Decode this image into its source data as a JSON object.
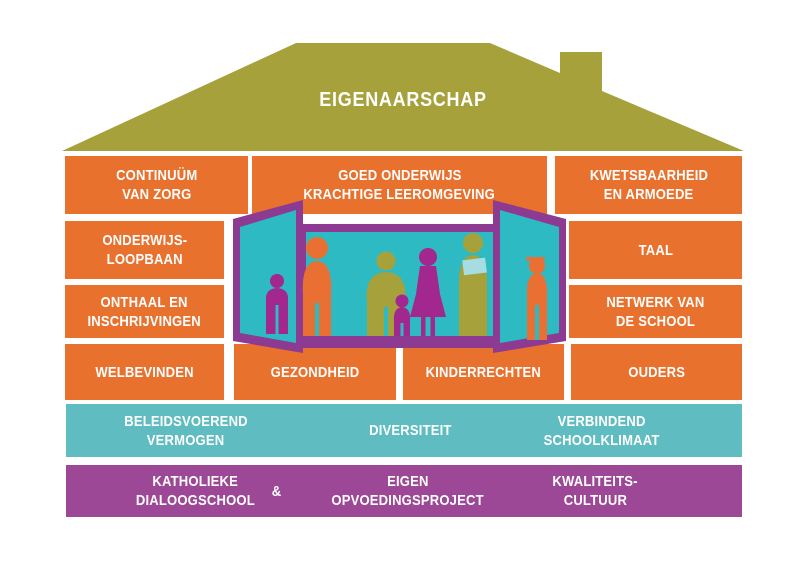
{
  "colors": {
    "roof_olive": "#A6A13B",
    "block_orange": "#E8712E",
    "bar_teal": "#5FBCC1",
    "bar_purple": "#9D4896",
    "window_frame_purple": "#8D3A92",
    "window_teal": "#2EBAC2",
    "figure_orange": "#E96F33",
    "figure_olive": "#A6A13B",
    "figure_magenta": "#A2278F",
    "tablet_light_teal": "#A5DDE3",
    "text_white": "#FFFFFF"
  },
  "roof": {
    "label": "EIGENAARSCHAP"
  },
  "rows": {
    "row1": {
      "continuum": {
        "line1": "CONTINUÜM",
        "line2": "VAN ZORG"
      },
      "goed_onderwijs": {
        "line1": "GOED ONDERWIJS",
        "line2": "KRACHTIGE LEEROMGEVING"
      },
      "kwetsbaarheid": {
        "line1": "KWETSBAARHEID",
        "line2": "EN ARMOEDE"
      }
    },
    "row2": {
      "onderwijsloopbaan": {
        "line1": "ONDERWIJS-",
        "line2": "LOOPBAAN"
      },
      "taal": {
        "line1": "TAAL"
      }
    },
    "row3": {
      "onthaal": {
        "line1": "ONTHAAL EN",
        "line2": "INSCHRIJVINGEN"
      },
      "netwerk": {
        "line1": "NETWERK VAN",
        "line2": "DE SCHOOL"
      }
    },
    "row4": {
      "welbevinden": {
        "line1": "WELBEVINDEN"
      },
      "gezondheid": {
        "line1": "GEZONDHEID"
      },
      "kinderrechten": {
        "line1": "KINDERRECHTEN"
      },
      "ouders": {
        "line1": "OUDERS"
      }
    }
  },
  "teal_bar": {
    "beleidsvoerend": {
      "line1": "BELEIDSVOEREND",
      "line2": "VERMOGEN"
    },
    "diversiteit": {
      "line1": "DIVERSITEIT"
    },
    "verbindend": {
      "line1": "VERBINDEND",
      "line2": "SCHOOLKLIMAAT"
    }
  },
  "purple_bar": {
    "katholieke": {
      "line1": "KATHOLIEKE",
      "line2": "DIALOOGSCHOOL"
    },
    "ampersand": "&",
    "eigen": {
      "line1": "EIGEN",
      "line2": "OPVOEDINGSPROJECT"
    },
    "kwaliteitscultuur": {
      "line1": "KWALITEITS-",
      "line2": "CULTUUR"
    }
  },
  "window": {
    "figures": [
      "child-silhouette",
      "man-silhouette",
      "heavyset-person-silhouette",
      "toddler-silhouette",
      "woman-silhouette",
      "woman-with-tablet-silhouette",
      "teen-with-cap-silhouette"
    ]
  }
}
